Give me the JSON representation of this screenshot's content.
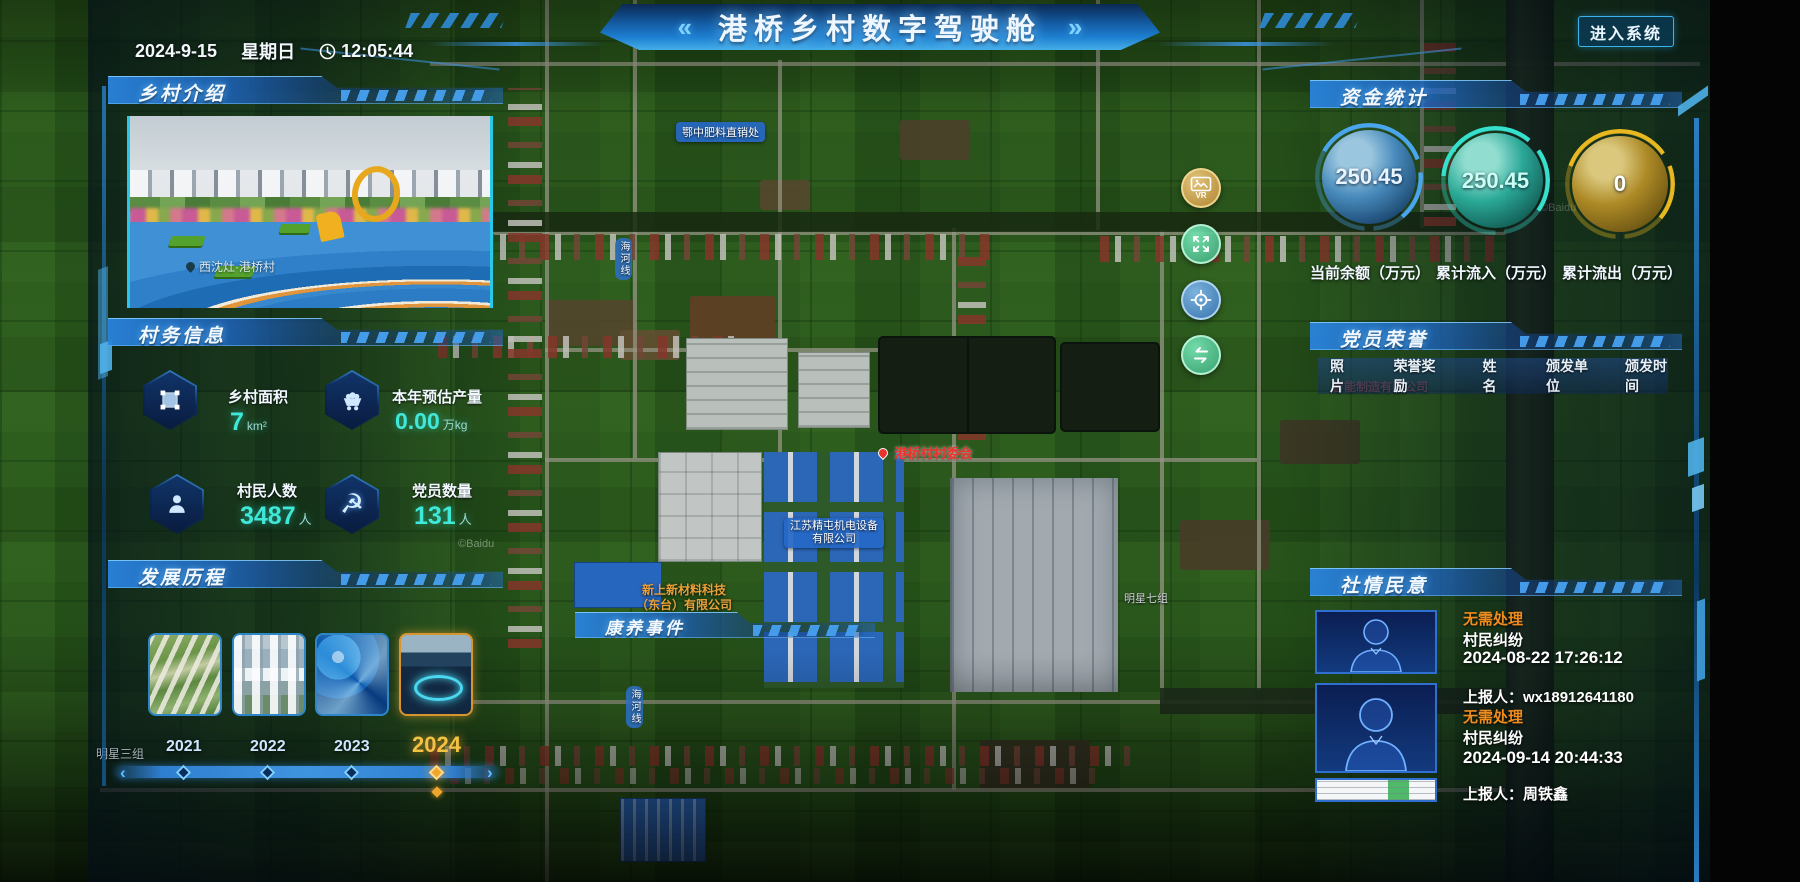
{
  "topbar": {
    "date": "2024-9-15",
    "weekday": "星期日",
    "time": "12:05:44",
    "enter_button": "进入系统"
  },
  "header": {
    "title": "港桥乡村数字驾驶舱",
    "chevron_left": "«",
    "chevron_right": "»"
  },
  "panels": {
    "intro": {
      "title": "乡村介绍",
      "photo_caption": "西沈灶·港桥村"
    },
    "affairs": {
      "title": "村务信息",
      "stats": [
        {
          "label": "乡村面积",
          "value": "7",
          "unit": "km²"
        },
        {
          "label": "本年预估产量",
          "value": "0.00",
          "unit": "万kg"
        },
        {
          "label": "村民人数",
          "value": "3487",
          "unit": "人"
        },
        {
          "label": "党员数量",
          "value": "131",
          "unit": "人"
        }
      ]
    },
    "history": {
      "title": "发展历程",
      "years": [
        "2021",
        "2022",
        "2023",
        "2024"
      ],
      "active_year": "2024",
      "prev_arrow": "‹",
      "next_arrow": "›"
    },
    "health": {
      "title": "康养事件"
    },
    "funds": {
      "title": "资金统计",
      "gauges": [
        {
          "value": "250.45",
          "label": "当前余额（万元）",
          "color": "#4aa3e8"
        },
        {
          "value": "250.45",
          "label": "累计流入（万元）",
          "color": "#2fd8c8"
        },
        {
          "value": "0",
          "label": "累计流出（万元）",
          "color": "#d4a017"
        }
      ]
    },
    "honors": {
      "title": "党员荣誉",
      "columns": [
        "照片",
        "荣誉奖励",
        "姓名",
        "颁发单位",
        "颁发时间"
      ]
    },
    "sentiment": {
      "title": "社情民意",
      "entries": [
        {
          "status": "无需处理",
          "type": "村民纠纷",
          "time": "2024-08-22 17:26:12",
          "reporter": "上报人：wx18912641180"
        },
        {
          "status": "无需处理",
          "type": "村民纠纷",
          "time": "2024-09-14 20:44:33",
          "reporter": "上报人：周铁鑫"
        }
      ]
    }
  },
  "map": {
    "labels": {
      "fertilizer": "鄂中肥料直销处",
      "road_name": "海河线",
      "committee": "港桥村村委会",
      "company_blue_line1": "江苏精屯机电设备",
      "company_blue_line2": "有限公司",
      "company_orange_line1": "新上新材料科技",
      "company_orange_line2": "（东台）有限公司",
      "group_seven": "明星七组",
      "group_three": "明星三组",
      "factory_faint": "智能制造有限公司",
      "vr_button_text": "VR"
    },
    "watermark": "©Baidu"
  },
  "colors": {
    "accent_cyan": "#35e0d0",
    "highlight_orange": "#f0a62a",
    "status_orange": "#f08c1e",
    "balance_blue": "#4aa3e8",
    "inflow_teal": "#2fd8c8",
    "outflow_gold": "#d4a017",
    "header_blue": "#1e7fd0"
  }
}
